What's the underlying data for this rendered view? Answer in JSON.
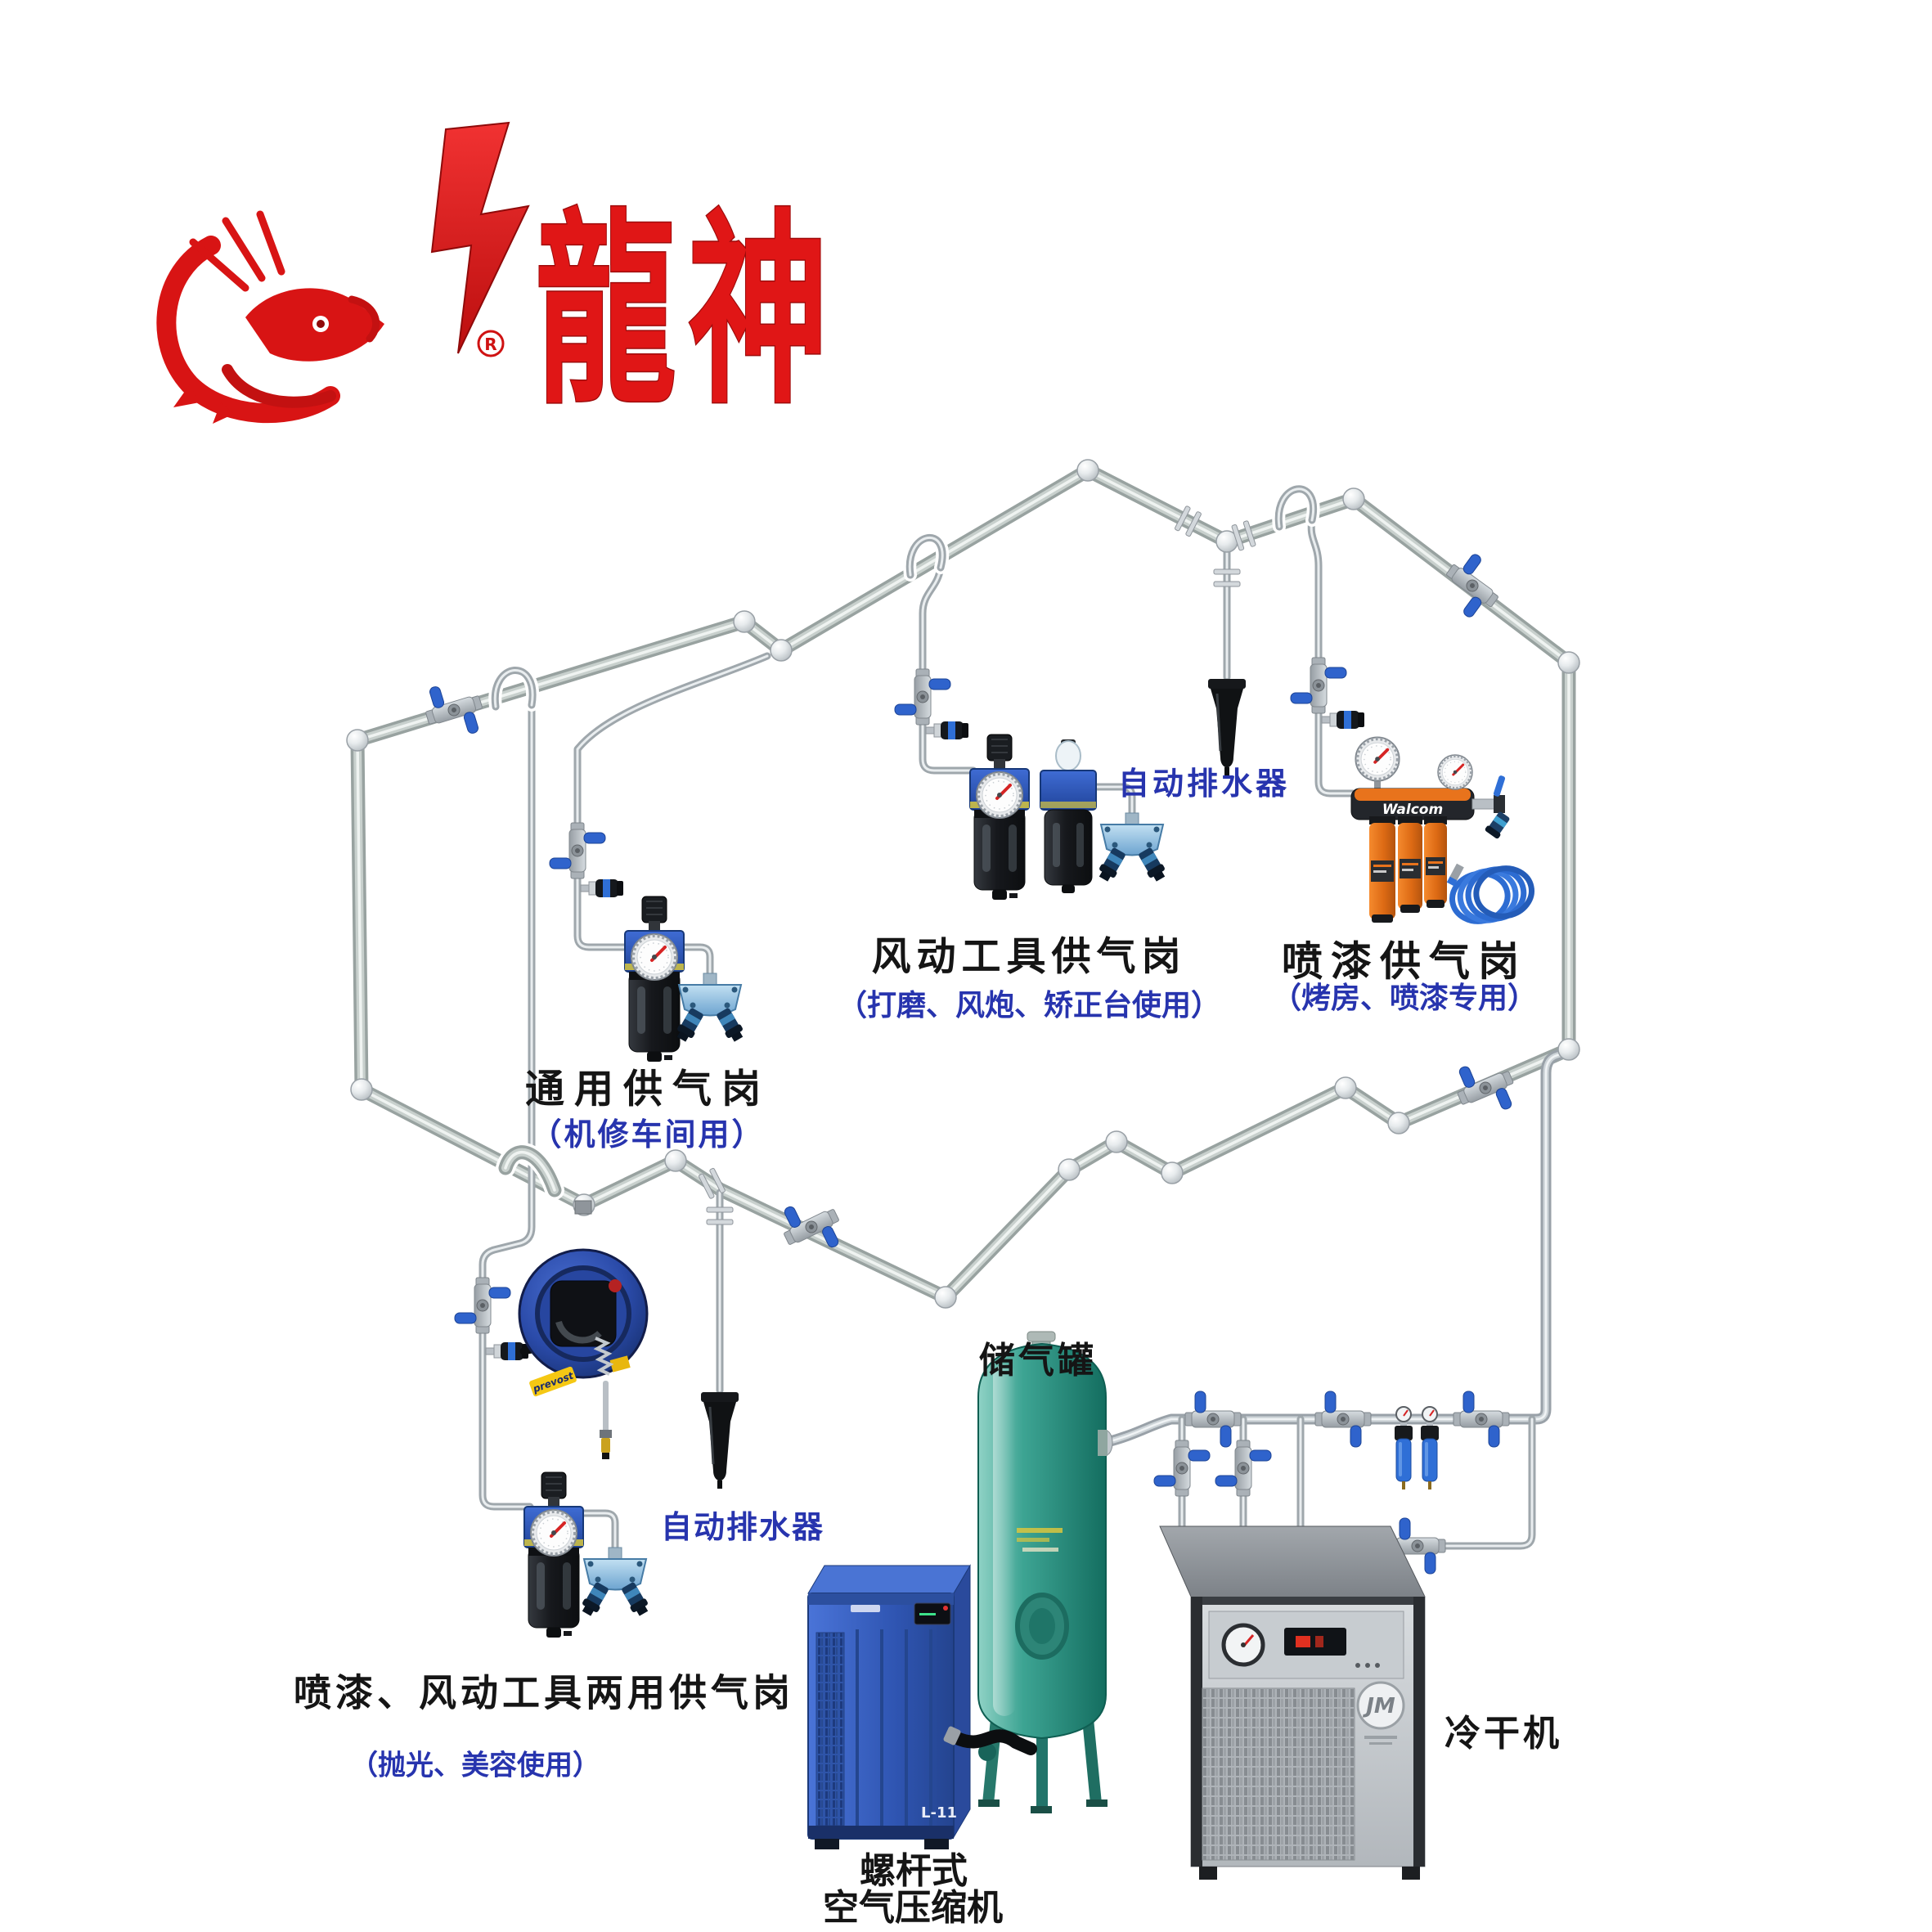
{
  "logo": {
    "brand_characters": "龍神",
    "registered_mark": "R",
    "color": "#e01616"
  },
  "stations": {
    "general": {
      "title": "通用供气岗",
      "subtitle": "（机修车间用）"
    },
    "pneumatic_tools": {
      "title": "风动工具供气岗",
      "subtitle": "（打磨、风炮、矫正台使用）"
    },
    "spray_paint": {
      "title": "喷漆供气岗",
      "subtitle": "（烤房、喷漆专用）"
    },
    "dual_use": {
      "title": "喷漆、风动工具两用供气岗",
      "subtitle": "（抛光、美容使用）"
    }
  },
  "annotations": {
    "auto_drain_right": "自动排水器",
    "auto_drain_left": "自动排水器"
  },
  "equipment": {
    "air_tank": {
      "label": "储气罐"
    },
    "compressor": {
      "label_line1": "螺杆式",
      "label_line2": "空气压缩机",
      "model": "L-11"
    },
    "dryer": {
      "label": "冷干机",
      "logo": "JM"
    },
    "paint_filter": {
      "brand": "Walcom"
    },
    "hose_reel": {
      "brand": "prevost"
    }
  },
  "colors": {
    "label_black": "#151515",
    "label_blue": "#2734ae",
    "pipe_silver": "#98a2a0",
    "valve_handle_blue": "#2f63cc",
    "tank_teal": "#2e9e8f",
    "compressor_blue": "#3a63c8",
    "cartridge_orange": "#e8731c",
    "drain_black": "#121416"
  }
}
